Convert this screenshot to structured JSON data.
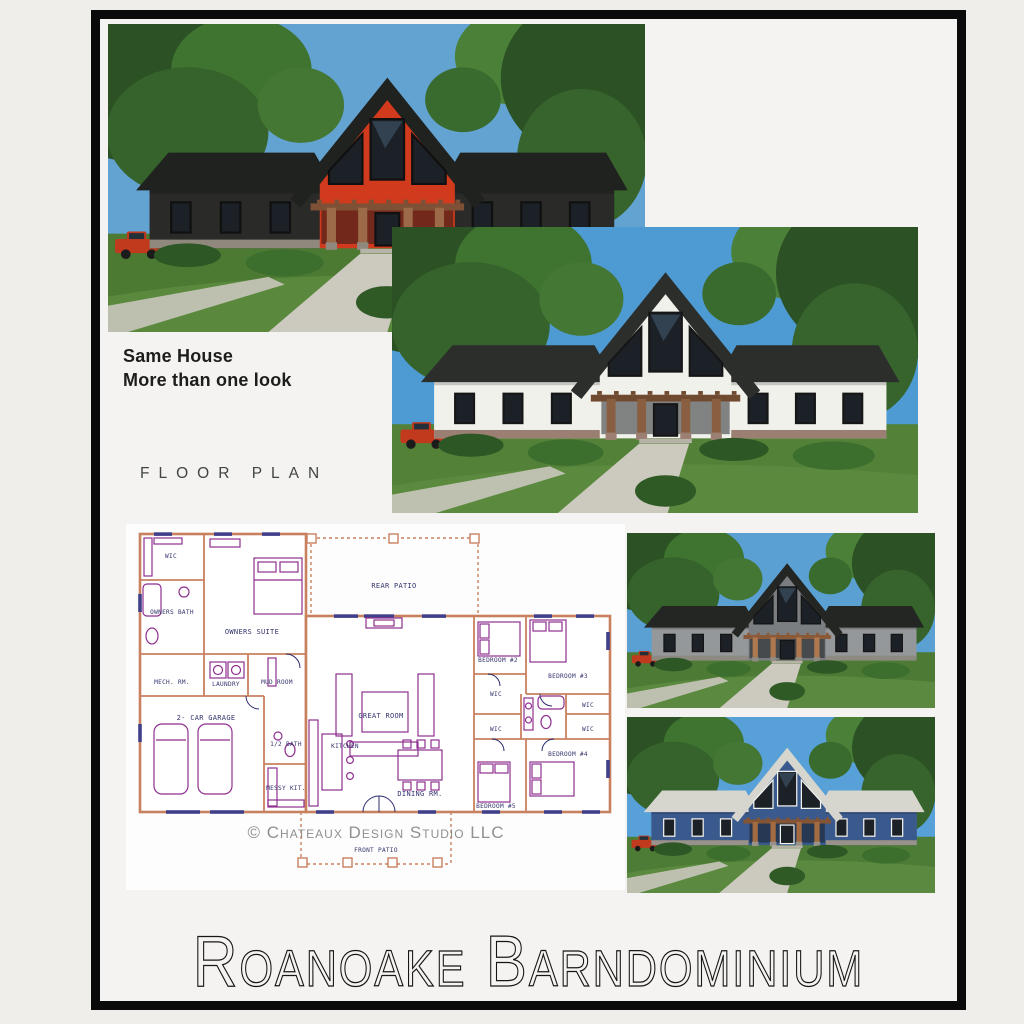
{
  "frame": {
    "page_bg": "#efeeea",
    "border_color": "#0a0a0a",
    "inner_bg": "#f4f3f1"
  },
  "captions": {
    "tagline_line1": "Same House",
    "tagline_line2": "More than one look",
    "section_label": "FLOOR PLAN",
    "title": "Roanoake Barndominium"
  },
  "renders": [
    {
      "name": "dark-siding-red-gable",
      "colors": {
        "sky": "#63a3d2",
        "siding": "#2a2b28",
        "gable": "#d23a1d",
        "roof": "#20221f",
        "trim": "#101010",
        "wood": "#9c6a48",
        "wood-dark": "#7e5136",
        "stone": "#8f887c",
        "grass": "#4c7a33",
        "truck": "#c13a1e"
      }
    },
    {
      "name": "white-siding-dark-roof",
      "colors": {
        "sky": "#4e9bd3",
        "siding": "#f1f1ec",
        "gable": "#f1f1ec",
        "roof": "#2c2e2c",
        "trim": "#161616",
        "wood": "#8a5e40",
        "wood-dark": "#6f4a30",
        "stone": "#9b7f72",
        "grass": "#538138",
        "truck": "#c13a1e"
      }
    },
    {
      "name": "gray-siding",
      "colors": {
        "sky": "#5aa0d2",
        "siding": "#95989a",
        "gable": "#7b7e81",
        "roof": "#242624",
        "trim": "#141414",
        "wood": "#b0784e",
        "wood-dark": "#8a5a38",
        "stone": "#8d8a82",
        "grass": "#4d7b36",
        "truck": "#c13a1e"
      }
    },
    {
      "name": "blue-siding-light-roof",
      "colors": {
        "sky": "#57a0d8",
        "siding": "#3a5a8e",
        "gable": "#3a5a8e",
        "roof": "#d6d6cf",
        "trim": "#f2f2ee",
        "wood": "#a36b42",
        "wood-dark": "#845433",
        "stone": "#98928a",
        "grass": "#4d7c37",
        "truck": "#c13a1e"
      }
    }
  ],
  "floor_plan": {
    "watermark": "© Chateaux Design Studio LLC",
    "colors": {
      "wall": "#c9805f",
      "furniture": "#8f2f8f",
      "label": "#34346e",
      "window": "#3f3f8a",
      "watermark": "#90908e"
    },
    "labels": {
      "wic1": "WIC",
      "owners_bath": "OWNERS BATH",
      "owners_suite": "OWNERS SUITE",
      "mech": "MECH. RM.",
      "laundry": "LAUNDRY",
      "mud": "MUD ROOM",
      "garage": "2- CAR GARAGE",
      "rear_patio": "REAR PATIO",
      "great": "GREAT ROOM",
      "kitchen": "KITCHEN",
      "half_bath": "1/2 BATH",
      "messy": "MESSY KIT.",
      "dining": "DINING RM.",
      "bed2": "BEDROOM #2",
      "bed3": "BEDROOM #3",
      "bed4": "BEDROOM #4",
      "bed5": "BEDROOM #5",
      "wic2": "WIC",
      "wic3": "WIC",
      "wic4": "WIC",
      "wic5": "WIC",
      "front_patio": "FRONT PATIO"
    }
  }
}
